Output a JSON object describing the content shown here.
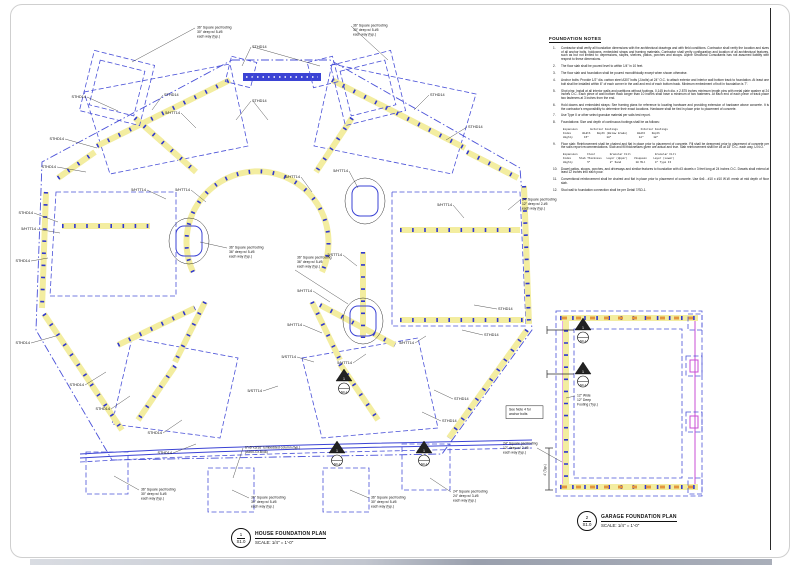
{
  "notes_panel": {
    "title": "FOUNDATION NOTES",
    "items": [
      {
        "num": "1.",
        "text": "Contractor shall verify all foundation dimensions with the architectural drawings and with field conditions.  Contractor shall verify the location and sizes of all anchor bolts, holdowns, embedded straps and framing materials.  Contractor shall verify configuration and location of all architectural features, such as but not limited to: depressions, slopes, shelves, patios, porches and stoops.  Alpine Structural Consultants has not assumed liability with respect to these dimensions."
      },
      {
        "num": "2.",
        "text": "The floor slab shall be poured level to within 1/4\" in 10 feet."
      },
      {
        "num": "3.",
        "text": "The floor slab and foundation shall be poured monolithically except when shown otherwise."
      },
      {
        "num": "4.",
        "text": "Anchor bolts:  Provide 1/2\" dia. carbon steel A307 bolts (J-bolts) at 24\" O.C. to attach exterior and interior wall bottom track to foundation.  At least one bolt shall be installed within 6\" of each corner in the wall and end of each bottom track.  Minimum embedment of bolt in foundation is 7\"."
      },
      {
        "num": "5.",
        "text": "Shot pins:  Install at all interior walls and partitions without footings, 0.145 inch dia. x 2.875 inches minimum length pins with metal plate washer at 24 inches O.C.  Each piece of wall bottom track longer than 10 inches shall have a minimum of two fasteners.  At each end of each piece of track place two fasteners at 3 inches from the end."
      },
      {
        "num": "6.",
        "text": "Hold downs and embedded straps:  See framing plans for reference to locating hardware and providing extension of hardware above concrete.  It is the contractor's responsibility to determine their exact locations.  Hardware shall be tied in place prior to placement of concrete."
      },
      {
        "num": "7.",
        "text": "Use Type II or other select granular material per soils test report."
      },
      {
        "num": "8.",
        "text": "Foundations:  Size and depth of continuous footings shall be as follows:",
        "table": [
          "Expansion        Exterior Footings              Interior Footings",
          "Index       Width    Depth (Below Grade)      Width    Depth",
          "Highly       15\"           18\"                 12\"      18\""
        ]
      },
      {
        "num": "9.",
        "text": "Floor slab:  Reinforcement shall be chaired and flat in place prior to placement of concrete.  Fill shall be deepened prior to placement of concrete per the soils report recommendations.  Slab and fill thicknesses given are actual and true.  Slab reinforcement shall be #3 at 18\" O.C. each way, U.N.O.",
        "table": [
          "Expansion      Floor         Granular Fill               Granular Fill",
          "Index     Slab Thickness   Layer (Upper)    Visqueen    Layer (Lower)",
          "Highly         5\"            2\" Sand         10 Mil      4\" Type II"
        ]
      },
      {
        "num": "10.",
        "text": "Dowel patios, stoops, porches, and driveways and similar features to foundation with #3 dowels x 3 feet long at 24 inches O.C.  Dowels shall extend at least 12 inches into each pour."
      },
      {
        "num": "11.",
        "text": "Conventional reinforcement shall be chaired and flat in place prior to placement of concrete.  Use 6x6 - #10 x #10 W.W. mesh at mid depth of floor slab."
      },
      {
        "num": "12.",
        "text": "Stud wall to foundation connection shall be per Detail 7/SD-1."
      }
    ]
  },
  "titles": {
    "house": {
      "number": "1",
      "sheet": "S1.0",
      "title": "HOUSE FOUNDATION PLAN",
      "scale": "SCALE:   1/4\" = 1'-0\""
    },
    "garage": {
      "number": "2",
      "sheet": "S1.0",
      "title": "GARAGE FOUNDATION PLAN",
      "scale": "SCALE:   1/4\" = 1'-0\""
    }
  },
  "garage": {
    "dim_label": "4' (Typ.)"
  },
  "colors": {
    "wall_yellow": "#f3eda0",
    "line_blue": "#4a51d8",
    "mark_blue": "#3038cf",
    "magenta": "#c94fd4",
    "orange": "#e2973e"
  },
  "callouts": [
    {
      "t": "STHD14",
      "x": 86,
      "y": 98,
      "lx": 118,
      "ly": 111
    },
    {
      "t": "STHD14",
      "x": 64,
      "y": 140,
      "lx": 97,
      "ly": 148
    },
    {
      "t": "STHD14",
      "x": 56,
      "y": 168,
      "lx": 86,
      "ly": 172
    },
    {
      "t": "STHD14",
      "x": 33,
      "y": 214,
      "lx": 58,
      "ly": 222
    },
    {
      "t": "5/HTT14",
      "x": 36,
      "y": 230,
      "lx": 60,
      "ly": 233
    },
    {
      "t": "STHD14",
      "x": 30,
      "y": 262,
      "lx": 48,
      "ly": 258
    },
    {
      "t": "STHD14",
      "x": 30,
      "y": 344,
      "lx": 56,
      "ly": 336
    },
    {
      "t": "STHD14",
      "x": 84,
      "y": 386,
      "lx": 106,
      "ly": 372
    },
    {
      "t": "STHD14",
      "x": 110,
      "y": 410,
      "lx": 130,
      "ly": 396
    },
    {
      "t": "STHD14",
      "x": 162,
      "y": 434,
      "lx": 182,
      "ly": 420
    },
    {
      "t": "STHD14",
      "x": 172,
      "y": 454,
      "lx": 196,
      "ly": 444
    },
    {
      "t": "STHD14",
      "x": 252,
      "y": 48,
      "lx": 242,
      "ly": 66
    },
    {
      "t": "",
      "x": 252,
      "y": 48,
      "lx": 320,
      "ly": 66
    },
    {
      "t": "STHD14",
      "x": 252,
      "y": 102,
      "lx": 236,
      "ly": 120
    },
    {
      "t": "",
      "x": 252,
      "y": 102,
      "lx": 268,
      "ly": 120
    },
    {
      "t": "STHD14",
      "x": 164,
      "y": 96,
      "lx": 152,
      "ly": 110
    },
    {
      "t": "STHD14",
      "x": 430,
      "y": 96,
      "lx": 414,
      "ly": 110
    },
    {
      "t": "STHD14",
      "x": 468,
      "y": 128,
      "lx": 446,
      "ly": 140
    },
    {
      "t": "STHD14",
      "x": 498,
      "y": 310,
      "lx": 474,
      "ly": 305
    },
    {
      "t": "STHD14",
      "x": 484,
      "y": 336,
      "lx": 462,
      "ly": 330
    },
    {
      "t": "STHD14",
      "x": 454,
      "y": 400,
      "lx": 434,
      "ly": 390
    },
    {
      "t": "STHD14",
      "x": 442,
      "y": 422,
      "lx": 422,
      "ly": 412
    },
    {
      "t": "5/HTT14",
      "x": 180,
      "y": 114,
      "lx": 196,
      "ly": 128
    },
    {
      "t": "5/HTT14",
      "x": 146,
      "y": 191,
      "lx": 166,
      "ly": 199
    },
    {
      "t": "5/HTT14",
      "x": 190,
      "y": 191,
      "lx": 206,
      "ly": 202
    },
    {
      "t": "5/HTT14",
      "x": 300,
      "y": 178,
      "lx": 312,
      "ly": 192
    },
    {
      "t": "5/HTT14",
      "x": 348,
      "y": 172,
      "lx": 358,
      "ly": 188
    },
    {
      "t": "5/HTT14",
      "x": 452,
      "y": 206,
      "lx": 464,
      "ly": 218
    },
    {
      "t": "5/HTT14",
      "x": 312,
      "y": 292,
      "lx": 330,
      "ly": 302
    },
    {
      "t": "5/HTT14",
      "x": 302,
      "y": 326,
      "lx": 322,
      "ly": 333
    },
    {
      "t": "5/HTT14",
      "x": 352,
      "y": 364,
      "lx": 366,
      "ly": 354
    },
    {
      "t": "5/HTT14",
      "x": 414,
      "y": 344,
      "lx": 426,
      "ly": 336
    },
    {
      "t": "5/STT14",
      "x": 342,
      "y": 256,
      "lx": 357,
      "ly": 266
    },
    {
      "t": "5/STT14",
      "x": 296,
      "y": 358,
      "lx": 314,
      "ly": 362
    },
    {
      "t": "5/STT14",
      "x": 262,
      "y": 392,
      "lx": 278,
      "ly": 386
    }
  ],
  "annotations": [
    {
      "lines": [
        "36\" Square pad footing",
        "30\" deep w/ 5-#5",
        "each way (typ.)"
      ],
      "x": 196,
      "y": 26,
      "lx": 132,
      "ly": 62
    },
    {
      "lines": [
        "36\" Square pad footing",
        "30\" deep w/ 5-#5",
        "each way (typ.)"
      ],
      "x": 352,
      "y": 24,
      "lx": 388,
      "ly": 60
    },
    {
      "lines": [
        "36\" Square pad footing",
        "36\" deep w/ 5-#5",
        "each way (typ.)"
      ],
      "x": 228,
      "y": 246,
      "lx": 200,
      "ly": 242
    },
    {
      "lines": [
        "36\" Square pad footing",
        "36\" deep w/ 5-#5",
        "each way (typ.)"
      ],
      "x": 296,
      "y": 256,
      "fy": 270,
      "lx": 348,
      "ly": 304
    },
    {
      "lines": [
        "24\" Square pad footing",
        "12\" deep w/ 2-#5",
        "each way (typ.)"
      ],
      "x": 521,
      "y": 198,
      "lx": 508,
      "ly": 210
    },
    {
      "lines": [
        "See Note 4 for",
        "anchor bolts"
      ],
      "x": 508,
      "y": 408,
      "boxed": true,
      "w": 33
    },
    {
      "lines": [
        "6\"x6\"x3/16\" Embedded column (typ.)",
        "(A500-Gr.B/46)"
      ],
      "x": 244,
      "y": 446,
      "lx": 233,
      "ly": 478
    },
    {
      "lines": [
        "36\" Square pad footing",
        "30\" deep w/ 5-#5",
        "each way (typ.)"
      ],
      "x": 140,
      "y": 488,
      "lx": 114,
      "ly": 476
    },
    {
      "lines": [
        "36\" Square pad footing",
        "30\" deep w/ 5-#5",
        "each way (typ.)"
      ],
      "x": 250,
      "y": 496,
      "lx": 232,
      "ly": 490
    },
    {
      "lines": [
        "36\" Square pad footing",
        "30\" deep w/ 5-#5",
        "each way (typ.)"
      ],
      "x": 370,
      "y": 496,
      "lx": 350,
      "ly": 490
    },
    {
      "lines": [
        "24\" Square pad footing",
        "24\" deep w/ 3-#5",
        "each way (typ.)"
      ],
      "x": 452,
      "y": 490,
      "lx": 430,
      "ly": 478
    },
    {
      "lines": [
        "24\" Square pad footing",
        "12\" deep w/ 2-#5",
        "each way (typ.)"
      ],
      "x": 502,
      "y": 442,
      "fx": 537,
      "fy": 448,
      "lx": 562,
      "ly": 462
    },
    {
      "lines": [
        "12\" Wide",
        "12\" Deep",
        "Footing (Typ.)"
      ],
      "x": 576,
      "y": 394,
      "lx": 566,
      "ly": 398
    }
  ],
  "symbols": [
    {
      "x": 344,
      "y": 378,
      "num": "1",
      "ref": "SD-1"
    },
    {
      "x": 337,
      "y": 450,
      "num": "1",
      "ref": "SD-1"
    },
    {
      "x": 424,
      "y": 450,
      "num": "1",
      "ref": "SD-1"
    },
    {
      "x": 583,
      "y": 327,
      "num": "1",
      "ref": "SD-1"
    },
    {
      "x": 583,
      "y": 371,
      "num": "1",
      "ref": "SD-1"
    }
  ]
}
